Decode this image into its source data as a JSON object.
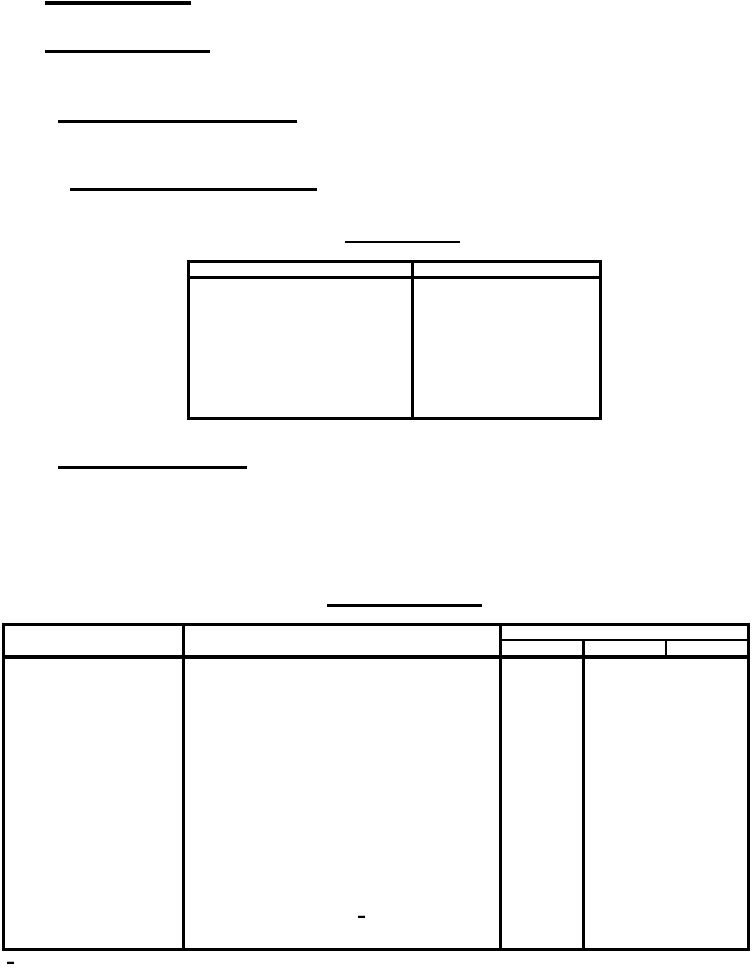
{
  "page": {
    "background_color": "#ffffff",
    "line_color": "#000000"
  },
  "rules": [
    {
      "name": "heading-1-underline",
      "x": 45,
      "y": 1,
      "w": 146,
      "h": 4
    },
    {
      "name": "heading-2-underline",
      "x": 45,
      "y": 50,
      "w": 165,
      "h": 3
    },
    {
      "name": "heading-3-underline",
      "x": 58,
      "y": 120,
      "w": 239,
      "h": 3
    },
    {
      "name": "heading-4-underline",
      "x": 70,
      "y": 188,
      "w": 247,
      "h": 3
    },
    {
      "name": "table1-title-underline",
      "x": 345,
      "y": 241,
      "w": 115,
      "h": 2
    },
    {
      "name": "table1-top-border",
      "x": 187,
      "y": 260,
      "w": 415,
      "h": 3
    },
    {
      "name": "table1-header-rule",
      "x": 187,
      "y": 276,
      "w": 415,
      "h": 3
    },
    {
      "name": "table1-bottom-border",
      "x": 187,
      "y": 417,
      "w": 415,
      "h": 3
    },
    {
      "name": "table1-left-border",
      "x": 187,
      "y": 260,
      "w": 3,
      "h": 160
    },
    {
      "name": "table1-column-divider",
      "x": 411,
      "y": 260,
      "w": 3,
      "h": 160
    },
    {
      "name": "table1-right-border",
      "x": 599,
      "y": 260,
      "w": 3,
      "h": 160
    },
    {
      "name": "section-underline",
      "x": 58,
      "y": 466,
      "w": 189,
      "h": 3
    },
    {
      "name": "table2-title-underline",
      "x": 327,
      "y": 604,
      "w": 155,
      "h": 3
    },
    {
      "name": "table2-top-border",
      "x": 2,
      "y": 623,
      "w": 748,
      "h": 3
    },
    {
      "name": "table2-header-rule",
      "x": 2,
      "y": 655,
      "w": 748,
      "h": 4
    },
    {
      "name": "table2-bottom-border",
      "x": 2,
      "y": 948,
      "w": 748,
      "h": 3
    },
    {
      "name": "table2-left-border",
      "x": 2,
      "y": 623,
      "w": 3,
      "h": 328
    },
    {
      "name": "table2-col1-divider",
      "x": 182,
      "y": 623,
      "w": 3,
      "h": 328
    },
    {
      "name": "table2-col2-divider",
      "x": 499,
      "y": 623,
      "w": 3,
      "h": 328
    },
    {
      "name": "table2-right-border",
      "x": 747,
      "y": 623,
      "w": 3,
      "h": 328
    },
    {
      "name": "table2-col3-span-rule",
      "x": 499,
      "y": 639,
      "w": 251,
      "h": 2
    },
    {
      "name": "table2-subcol1-divider",
      "x": 582,
      "y": 639,
      "w": 3,
      "h": 312
    },
    {
      "name": "table2-subcol2-divider",
      "x": 665,
      "y": 639,
      "w": 2,
      "h": 18
    }
  ],
  "glyphs": [
    {
      "name": "table2-col2-dash",
      "text": "–"
    },
    {
      "name": "footnote-dash",
      "text": "–"
    }
  ]
}
